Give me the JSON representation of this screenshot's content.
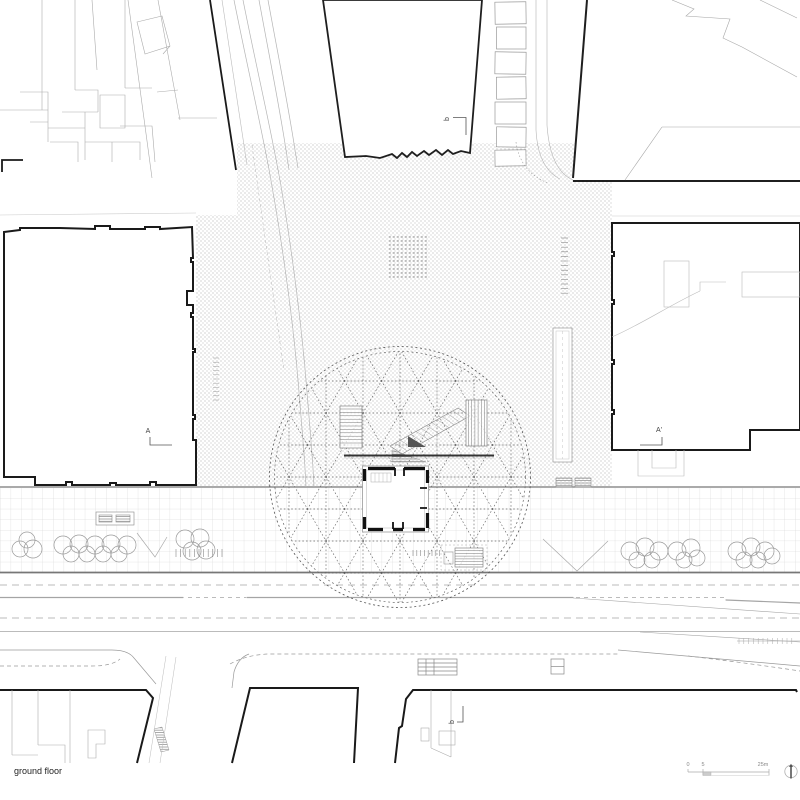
{
  "title": {
    "drawing_label": "ground floor"
  },
  "markers": {
    "section_a": "A",
    "section_a_prime": "A'",
    "section_b_top": "b",
    "section_b_bottom": "b"
  },
  "scalebar": {
    "tick_zero": "0",
    "tick_five": "5",
    "tick_max": "25m"
  },
  "icons": {
    "north_arrow": "north-arrow"
  },
  "colors": {
    "ink": "#1a1a1a",
    "line_gray": "#999999",
    "texture_gray": "#bdbdbd",
    "paper": "#ffffff"
  }
}
